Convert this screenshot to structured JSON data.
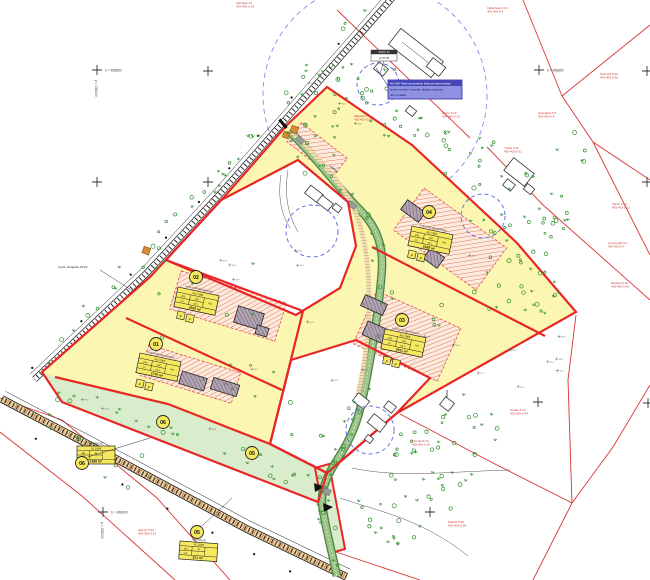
{
  "plots": [
    {
      "num": "01",
      "title": "UUSI RAKENNUSPAIKKA",
      "code": "AO 1001",
      "c1": "240",
      "c2": "120",
      "c3": "1:2",
      "c4": "e0.1",
      "side": "Iu½",
      "area": "2770 m²"
    },
    {
      "num": "02",
      "title": "UUSI RAKENNUSPAIKKA",
      "code": "AO 1002",
      "c1": "240",
      "c2": "120",
      "c3": "1:2",
      "c4": "e0.1",
      "side": "Iu½",
      "area": "2532 m²"
    },
    {
      "num": "03",
      "title": "UUSI RAKENNUSPAIKKA",
      "code": "AO 1003",
      "c1": "240",
      "c2": "120",
      "c3": "1:2",
      "c4": "e0.1",
      "side": "Iu½",
      "area": "2911 m²"
    },
    {
      "num": "04",
      "title": "UUSI RAKENNUSPAIKKA",
      "code": "AO 1004",
      "c1": "240",
      "c2": "120",
      "c3": "1:2",
      "c4": "e0.1",
      "side": "Iu½",
      "area": "2169 m²"
    },
    {
      "num": "05",
      "title": "VIHERALUE",
      "code": "VL 1005",
      "c1": "oja",
      "c2": "ist",
      "c3": "nur",
      "c4": "-",
      "side": "",
      "area": "671 m²"
    },
    {
      "num": "06",
      "title": "VIHERALUE",
      "code": "VL 1006",
      "c1": "oja",
      "c2": "ist",
      "c3": "nur",
      "c4": "-",
      "side": "",
      "area": "1420 m²"
    }
  ],
  "circle_labels": [
    "01",
    "02",
    "03",
    "04",
    "05",
    "06"
  ],
  "note_box": {
    "l1": "HUOM! Rakennuspaikan liittymä rakennetaan",
    "l2": "ennen tonttien myyntiä, tasaus nykyisen",
    "l3": "tien mukaan"
  },
  "well_box": {
    "l1": "KAIVO 12",
    "l2": "vp 57.35"
  },
  "grid": {
    "h_top": "h = 458850",
    "h_top2": "h = 458850",
    "h_bottom": "h = 458600",
    "v_left": "p = 158200",
    "v_bottom": "p = 158200"
  },
  "black_labels": {
    "powerline": "3-joht. ilmajohto 20 kV",
    "stream": "valtaoja"
  },
  "p_label": "p",
  "red_labels": [
    {
      "l1": "Vanhatie 13",
      "l2": "405-405-3-18"
    },
    {
      "l1": "Vähä-Niemi 5:4",
      "l2": "405-405-5-4"
    },
    {
      "l1": "Niemelä 5:36",
      "l2": "405-405-5-36"
    },
    {
      "l1": "Kotipalsta 5:9",
      "l2": "405-405-5-9"
    },
    {
      "l1": "Rinne 5:22",
      "l2": "405-405-5-22"
    },
    {
      "l1": "Ylitalo 5:31",
      "l2": "405-405-5-31"
    },
    {
      "l1": "Vainio 5:12",
      "l2": "405-405-5-12"
    },
    {
      "l1": "Levonmäki 5:7",
      "l2": "405-405-5-7"
    },
    {
      "l1": "Metsola 5:40",
      "l2": "405-405-5-40"
    },
    {
      "l1": "Mäkelä 5:15",
      "l2": "405-405-5-15"
    },
    {
      "l1": "Isotalo 5:44",
      "l2": "405-405-5-44"
    },
    {
      "l1": "Peltola 5:28",
      "l2": "405-405-5-28"
    },
    {
      "l1": "Alanen 5:33",
      "l2": "405-405-5-33"
    },
    {
      "l1": "Koivula 5:19",
      "l2": "405-405-5-19"
    }
  ],
  "colors": {
    "boundary": "#e82626",
    "parcel_line": "#d93434",
    "plot_fill": "#fbf6b2",
    "table_fill": "#f7e95f",
    "green_area": "#d9edcc",
    "stream": "#7fae6f",
    "tree": "#2f8f2f",
    "blue_dash": "#5566dd",
    "note_box": "#8f92e3"
  }
}
